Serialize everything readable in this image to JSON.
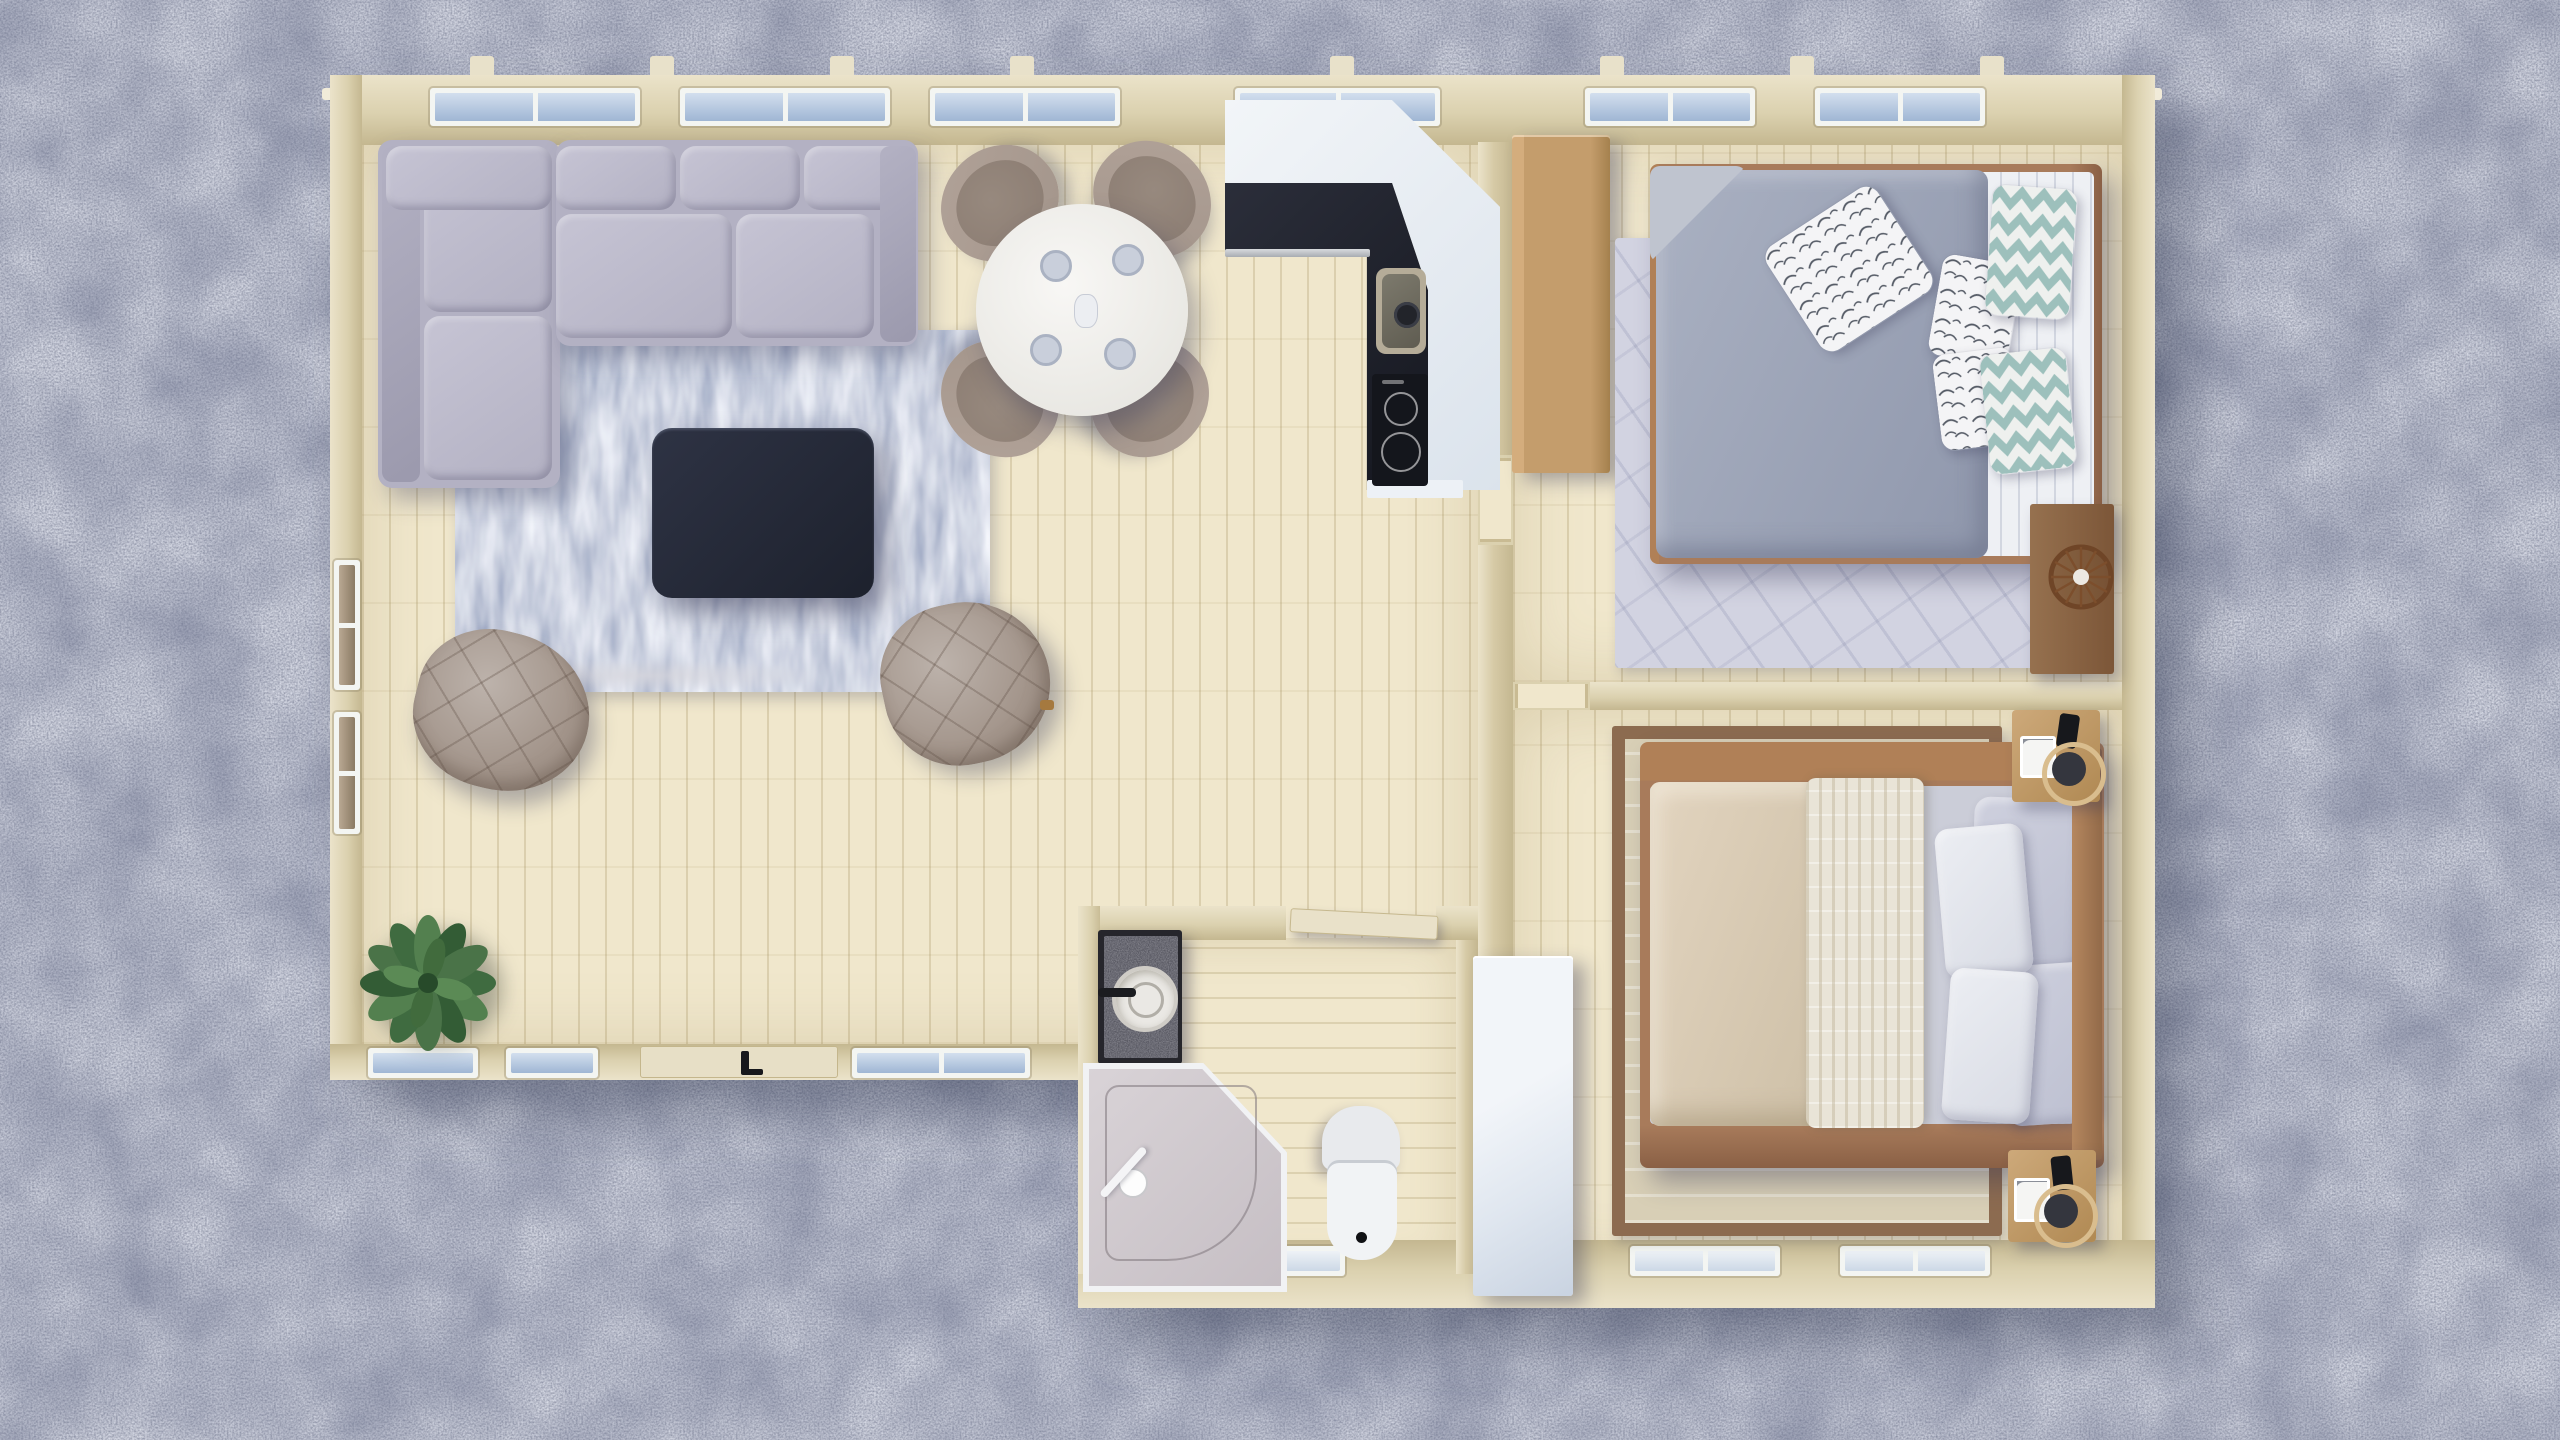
{
  "meta": {
    "title": "Aerial 3D render — small cabin floor plan on gravel ground",
    "view": "top-down",
    "ground": "blue-gray gravel"
  },
  "colors": {
    "gravel_base": "#838aab",
    "wall_wood": "#dbd1af",
    "wall_wood_dark": "#c4b790",
    "wall_face": "#ebe3ca",
    "eave": "#f1ebd9",
    "partition": "#d6caa6",
    "floor_base": "#f0e7cc",
    "frame_white": "#f3f5f2",
    "sofa_base": "#b3b1c3",
    "sofa_light": "#c6c4d4",
    "sofa_dark": "#9b99ad",
    "rug_mid": "#8a96bd",
    "coffee_table": "#262b3a",
    "chair_taupe": "#a3958b",
    "chair_taupe_dark": "#8b7c72",
    "dining_white": "#f4f3f0",
    "cup_gray": "#c9cfdb",
    "counter_white": "#edf1f6",
    "counter_dark": "#22242e",
    "steel": "#c2c6ca",
    "oak": "#c49d6c",
    "walnut": "#a87b5b",
    "rug1_lav": "#d2d3e1",
    "duvet_gray": "#9ca4b7",
    "sheet_white": "#eef0f4",
    "chevron_teal": "#9dc0bc",
    "leaf_ink": "#555b66",
    "rug2_tan": "#d8cfb6",
    "rug2_border": "#8c6b50",
    "bed2_beige": "#d8cab3",
    "bed2_knit": "#e9e4d7",
    "bed2_sheet": "#cbcdd8",
    "white_wardrobe": "#ecf0f6",
    "granite": "#54545e",
    "toilet": "#edeff1",
    "plant_mid": "#3f6b40",
    "rattan": "#7a4c2b"
  },
  "rooms": {
    "living_room": {
      "label": "Living area",
      "items": [
        "L-shaped corner sofa (gray fabric)",
        "distressed blue area rug",
        "dark square coffee table",
        "quilted swivel chair x2",
        "potted plant"
      ]
    },
    "dining_area": {
      "label": "Dining area",
      "items": [
        "round white table",
        "upholstered dining chair x4",
        "cups x4",
        "small jug"
      ]
    },
    "kitchen": {
      "label": "Kitchen",
      "items": [
        "L-shaped counter (white top, dark worktop)",
        "inset sink with faucet",
        "2-burner induction hob",
        "tall oak cabinet"
      ]
    },
    "bedroom_1": {
      "label": "Bedroom 1 (top right)",
      "items": [
        "double bed, walnut frame",
        "gray duvet",
        "striped white sheet",
        "leaf-print pillow x3",
        "teal chevron pillow x2",
        "light rug with diagonal weave",
        "dark wood side shelf",
        "rattan wheel decor"
      ]
    },
    "bedroom_2": {
      "label": "Bedroom 2 (bottom right)",
      "items": [
        "double bed, walnut frame",
        "beige crumpled duvet",
        "cream knit blanket",
        "lavender pillow x2",
        "white pillow x2",
        "tan bordered rug",
        "oak nightstand x2",
        "phone",
        "sketch card x2",
        "rattan tray with bowl x2",
        "white wardrobe"
      ]
    },
    "bathroom": {
      "label": "Bathroom (bottom middle)",
      "items": [
        "granite vanity with round basin and black faucet",
        "corner shower cabin with glass",
        "white toilet"
      ]
    },
    "openings": {
      "top_wall_windows": 5,
      "left_wall_windows": 2,
      "south_wall_windows": 3,
      "south_wing_windows": 3,
      "entrance_door": "south wall with black handle",
      "interior_doors": [
        "bathroom door (open leaf)",
        "bedroom 1 doorway",
        "bedroom 2 doorway"
      ]
    }
  }
}
